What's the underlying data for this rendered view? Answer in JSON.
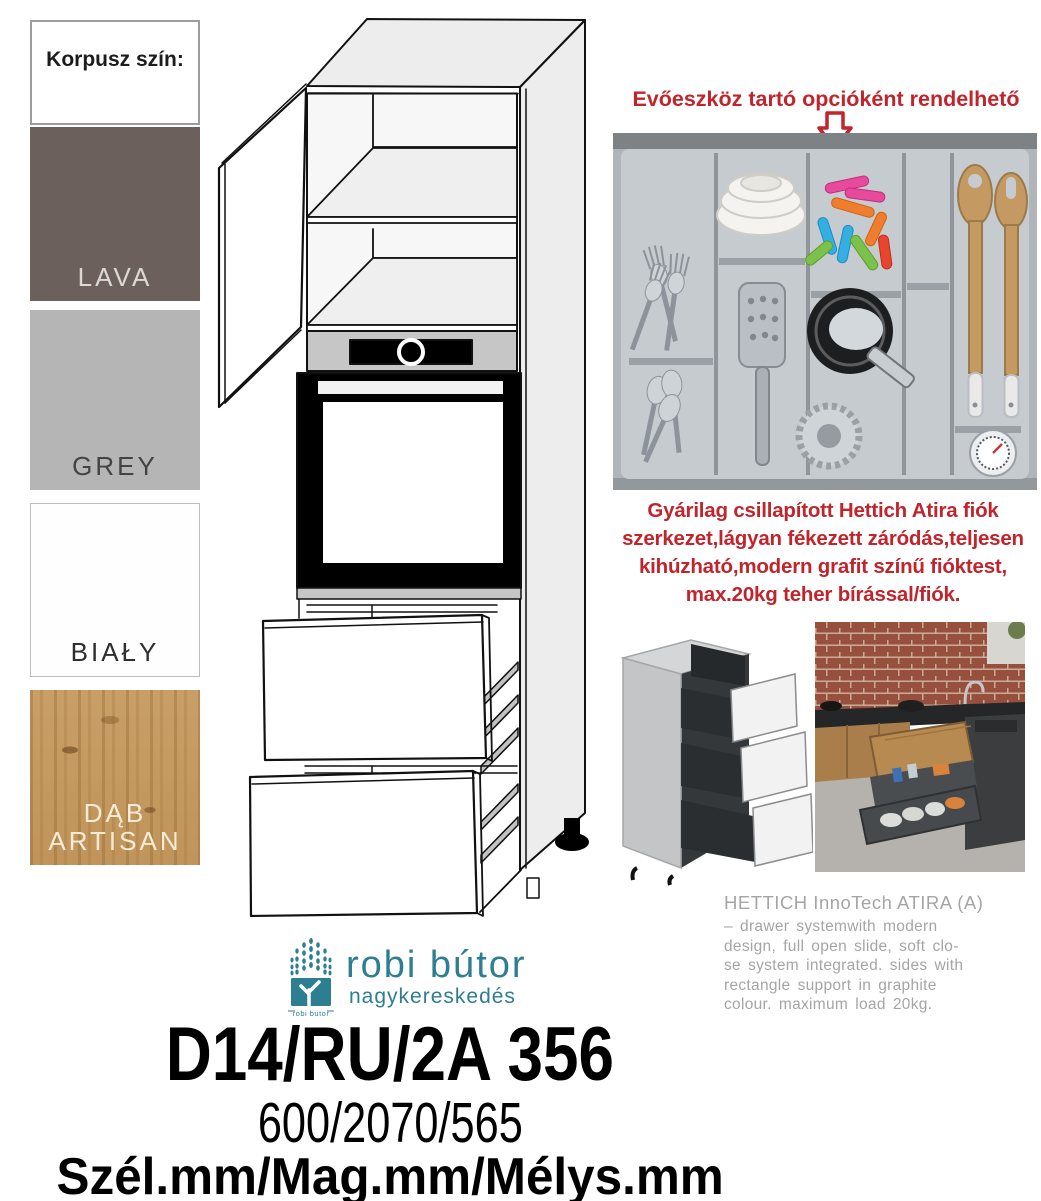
{
  "color_panel": {
    "title": "Korpusz szín:",
    "swatches": [
      {
        "name": "LAVA",
        "color": "#6b605c"
      },
      {
        "name": "GREY",
        "color": "#b5b5b5"
      },
      {
        "name": "BIAŁY",
        "color": "#ffffff"
      },
      {
        "name": "DĄB ARTISAN",
        "color": "#c49a62"
      }
    ]
  },
  "cutlery_option": {
    "heading": "Evőeszköz tartó opcióként rendelhető",
    "heading_color": "#c2242b",
    "arrow_icon": "down-arrow"
  },
  "drawer_feature_note": {
    "text": "Gyárilag csillapított Hettich Atira fiók\nszerkezet,lágyan fékezett záródás,teljesen\nkihúzható,modern grafit színű fióktest,\nmax.20kg teher bírással/fiók.",
    "color": "#c2242b"
  },
  "hettich_info": {
    "title": "HETTICH InnoTech ATIRA (A)",
    "body": "– drawer systemwith modern\ndesign, full open slide, soft clo-\nse system integrated. sides with\nrectangle support in graphite\ncolour. maximum load 20kg.",
    "color": "#a5a5a5"
  },
  "brand": {
    "name": "robi bútor",
    "subtitle": "nagykereskedés",
    "icon": "tree-logo",
    "icon_caption": "robi butor",
    "color": "#2e7e92"
  },
  "product": {
    "code": "D14/RU/2A 356",
    "dimensions": "600/2070/565",
    "dimensions_legend": "Szél.mm/Mag.mm/Mélys.mm"
  }
}
